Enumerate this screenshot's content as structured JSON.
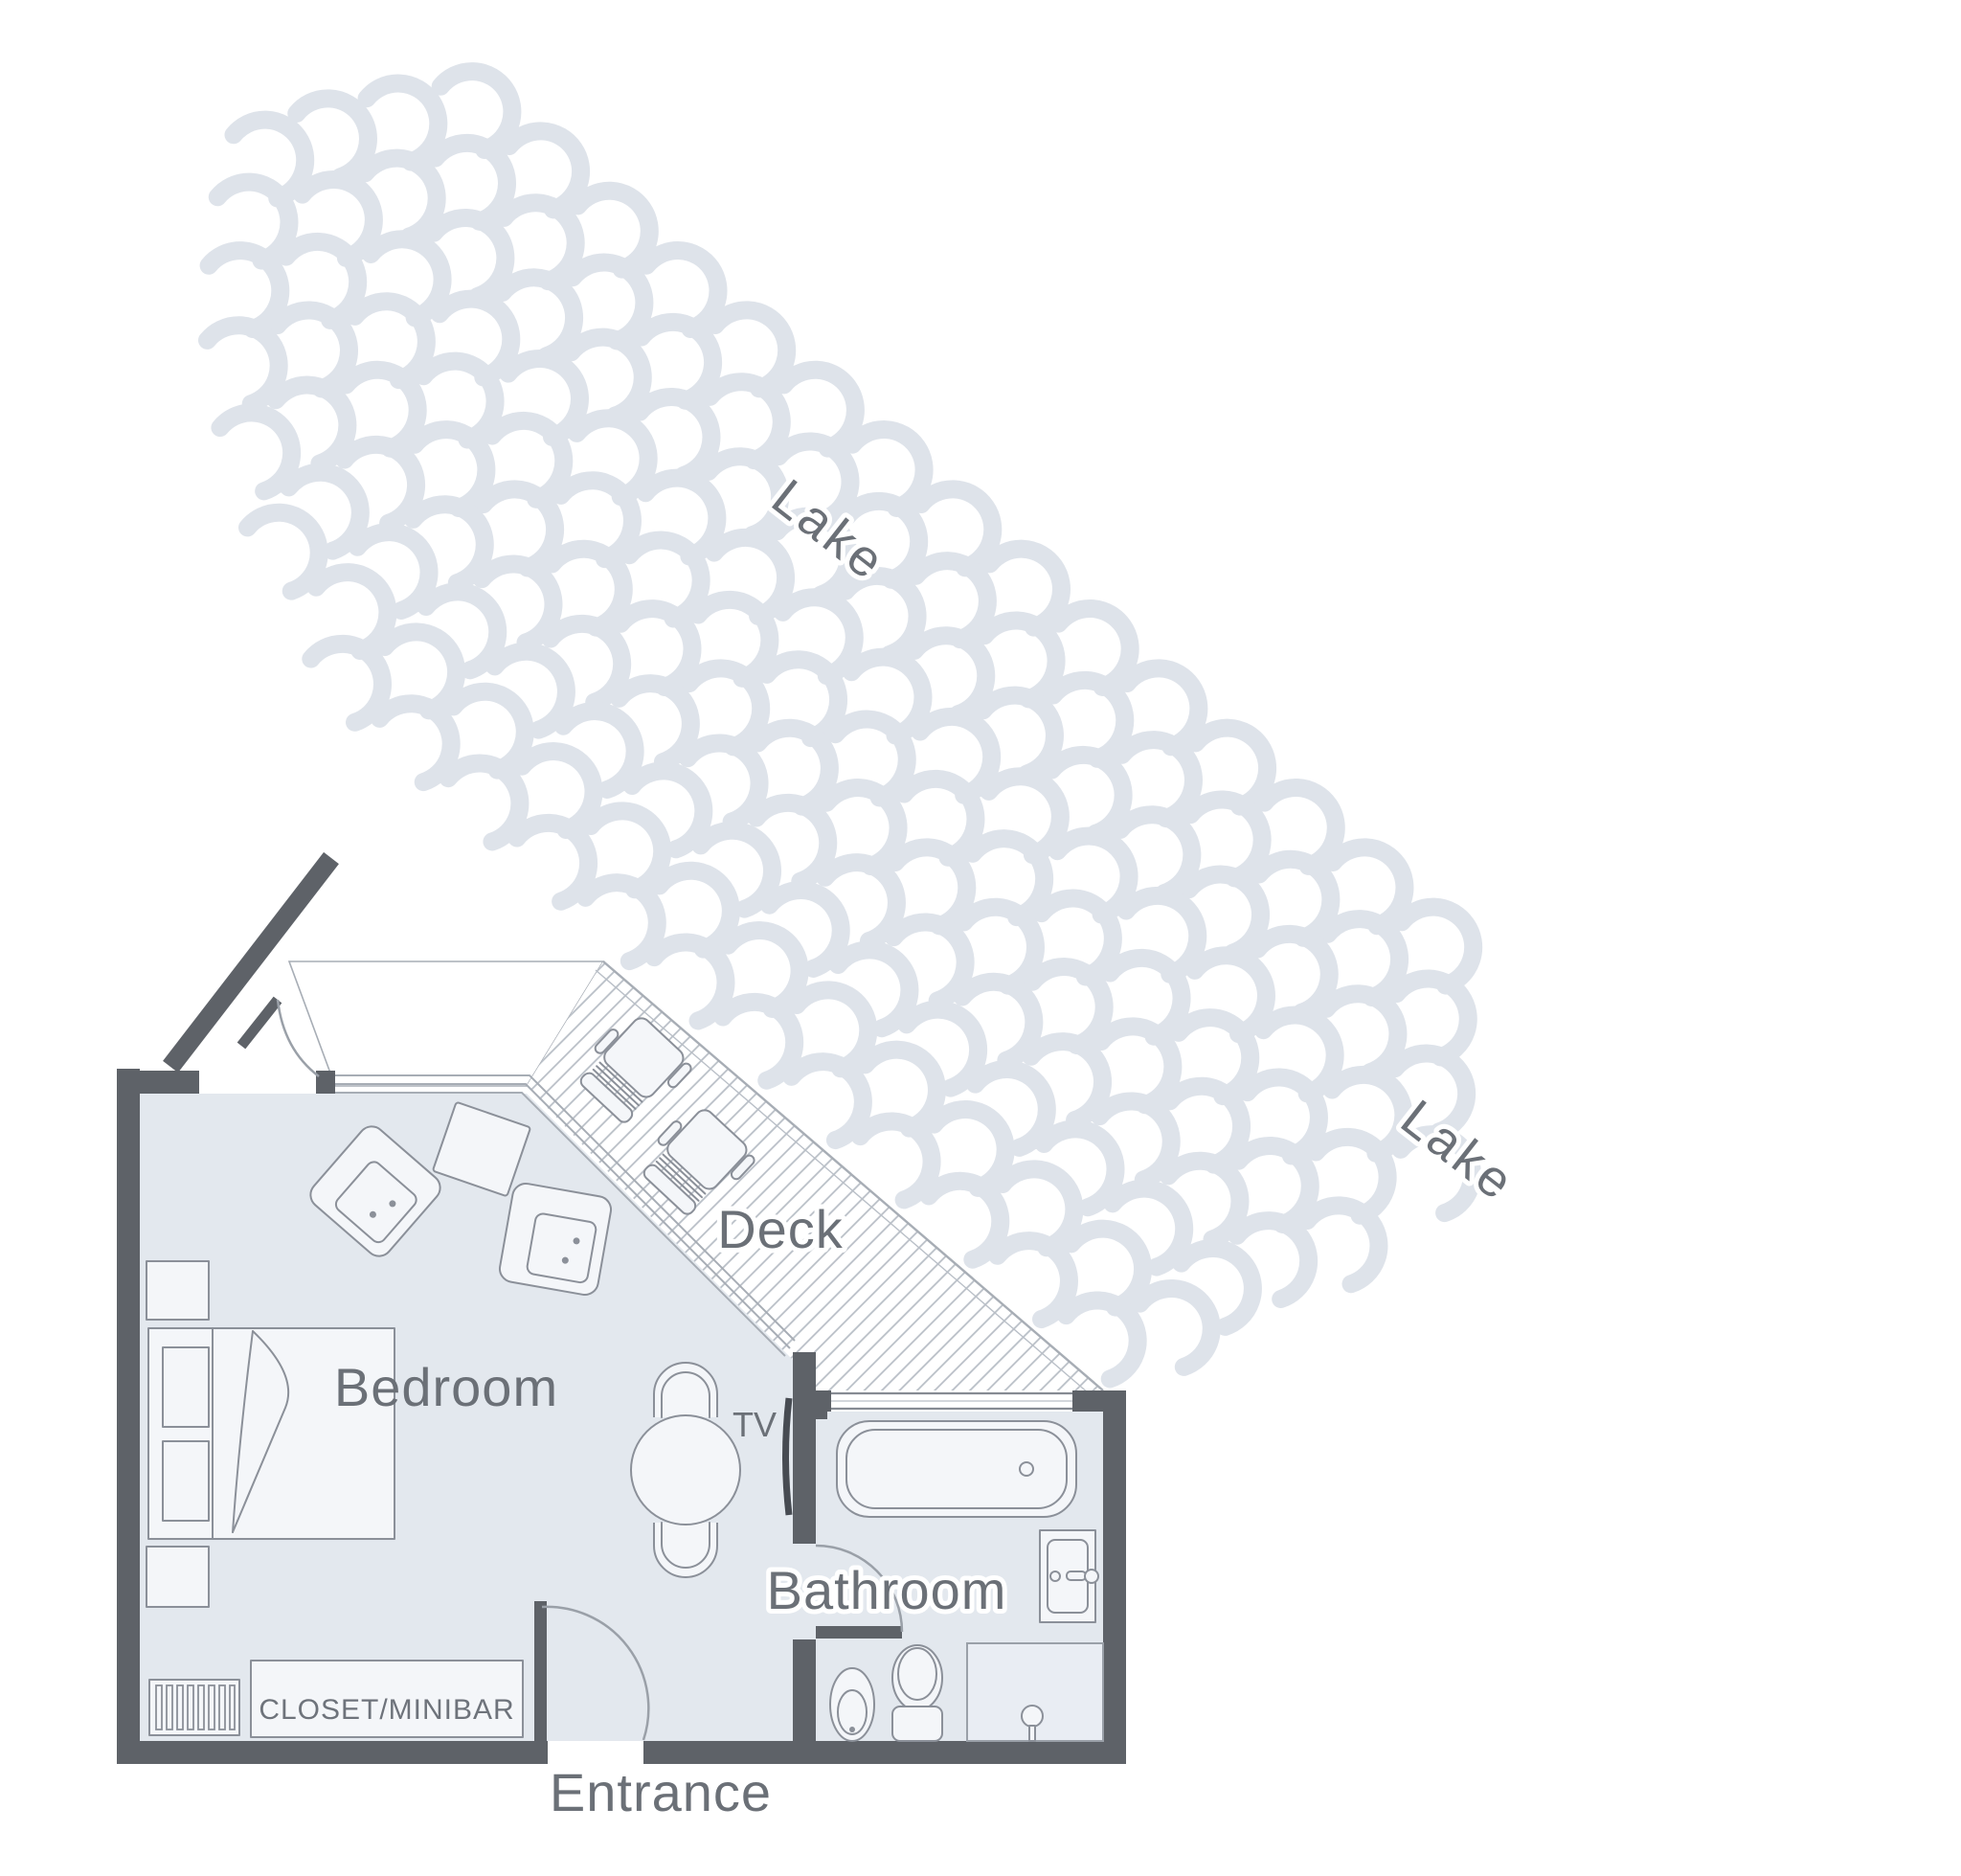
{
  "labels": {
    "lake_upper": "Lake",
    "lake_lower": "Lake",
    "deck": "Deck",
    "bedroom": "Bedroom",
    "bathroom": "Bathroom",
    "tv": "TV",
    "closet_minibar": "CLOSET/MINIBAR",
    "entrance": "Entrance"
  },
  "colors": {
    "wall": "#5e6268",
    "floor": "#e3e8ee",
    "furniture_fill": "#f4f6f9",
    "furniture_outline": "#8b9099",
    "thin_outline": "#a7adb5",
    "wave": "#dee3ea",
    "label_text": "#6b7077",
    "tv_screen": "#474b52",
    "background": "#ffffff"
  },
  "rooms": [
    {
      "name": "Bedroom",
      "furniture": [
        "double-bed",
        "headboard",
        "nightstand-upper",
        "nightstand-lower",
        "armchair-1",
        "armchair-2",
        "side-table",
        "round-table",
        "table-chair-top",
        "table-chair-bottom",
        "radiator",
        "closet-minibar",
        "tv"
      ]
    },
    {
      "name": "Bathroom",
      "furniture": [
        "bathtub",
        "sink",
        "toilet",
        "bidet",
        "shower"
      ]
    },
    {
      "name": "Deck",
      "furniture": [
        "lounge-chair-1",
        "lounge-chair-2"
      ]
    },
    {
      "name": "Entrance",
      "furniture": [
        "entrance-door"
      ]
    }
  ],
  "environment": {
    "water_body": "Lake",
    "wave_rows": 10
  }
}
